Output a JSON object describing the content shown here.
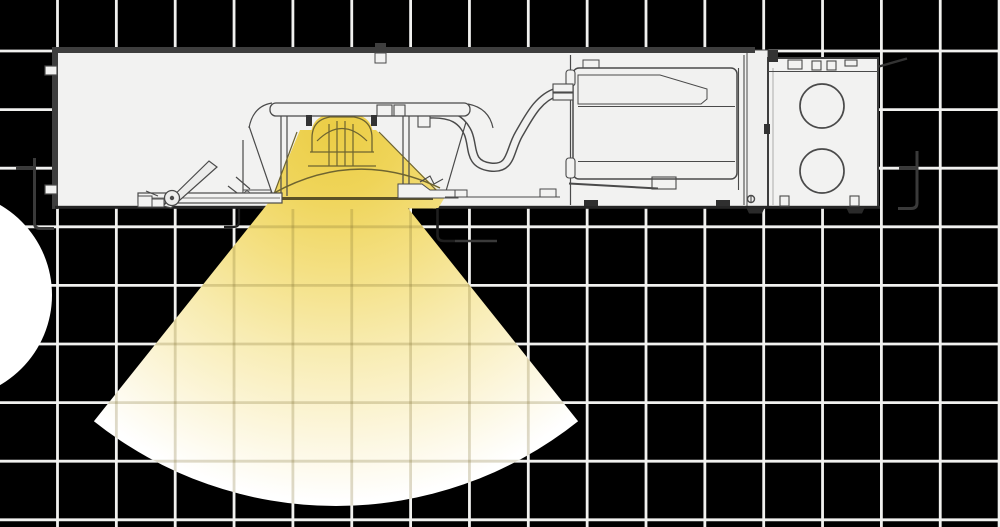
{
  "scene": {
    "name": "recessed-downlight-cross-section",
    "canvas": {
      "width": 1000,
      "height": 527
    },
    "background_color": "#000000"
  },
  "palette": {
    "grid_line": "#F1F1EF",
    "grid_line_in_beam": "rgba(122,106,44,0.25)",
    "housing_fill": "#F2F2F1",
    "housing_frame": "#3E3E3E",
    "line_art": "#4A4A4A",
    "line_art_dark": "#262626",
    "line_art_olive": "#6E6430",
    "aperture_line": "#4A431F",
    "bracket_gray": "#3A3A3A",
    "beam_core": "#EBCD45",
    "beam_upper": "#EFD458",
    "beam_mid": "#F4E083",
    "beam_soft": "#F8ECB2",
    "beam_faint": "#FCF6DC",
    "beam_edge": "#FFFFFF",
    "circle_color": "#FFFFFF"
  },
  "grid": {
    "origin_x": 57.5,
    "origin_y": 51,
    "spacing_x": 58.85,
    "spacing_y": 58.6,
    "columns": 17,
    "rows": 9,
    "line_width": 2.8,
    "ceiling_y": 209
  },
  "beam": {
    "apex_x": 336,
    "apex_y": 118,
    "radius": 388,
    "half_angle_deg": 38.6
  },
  "decor_circle": {
    "cx": -52,
    "cy": 295,
    "r": 104
  },
  "fixture": {
    "housing": {
      "x": 55,
      "y": 50,
      "width": 692,
      "height": 157
    },
    "junction_box": {
      "x": 768,
      "y": 58,
      "width": 110,
      "height": 149,
      "knockout_radius": 22,
      "knockouts": [
        {
          "cx": 822,
          "cy": 106
        },
        {
          "cx": 822,
          "cy": 171
        }
      ]
    },
    "driver_box": {
      "x": 573,
      "y": 68,
      "width": 164,
      "height": 111
    },
    "components": [
      "plenum-housing",
      "housing-frame",
      "end-plate",
      "junction-box",
      "knockout-circles",
      "led-driver",
      "flex-conduit",
      "mounting-plate",
      "led-light-engine",
      "reflector-cone",
      "ceiling-trim",
      "hanger-bar-clamp",
      "torsion-spring-bracket",
      "ceiling-line",
      "plaster-frame-bracket-left",
      "plaster-frame-bracket-right",
      "light-beam-cone",
      "background-grid",
      "corner-circle-decoration"
    ]
  }
}
